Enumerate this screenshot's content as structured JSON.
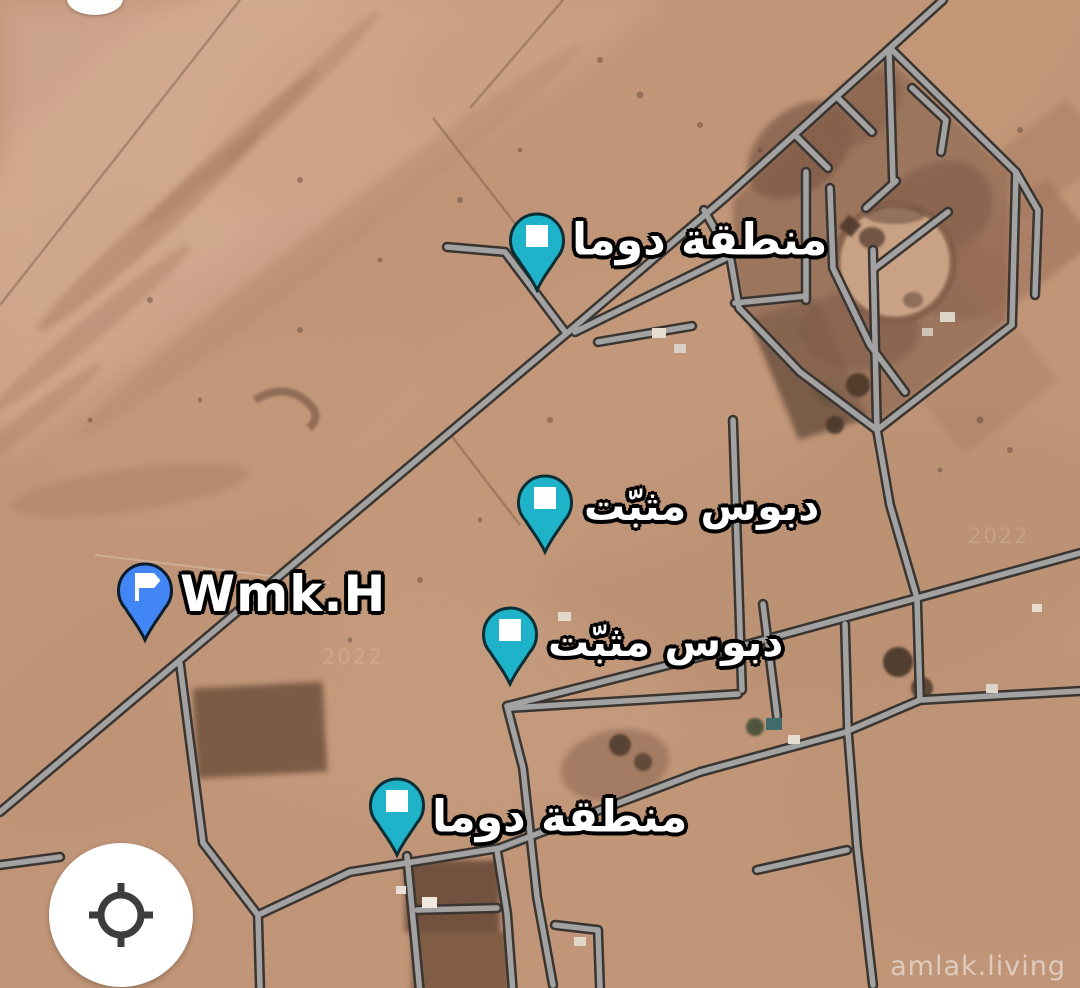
{
  "map": {
    "type": "satellite-imagery",
    "pins": [
      {
        "id": "pin-douma-north",
        "label": "منطقة دوما",
        "style": "teal-square-pin"
      },
      {
        "id": "pin-dropped-1",
        "label": "دبوس مثبّت",
        "style": "teal-square-pin"
      },
      {
        "id": "pin-dropped-2",
        "label": "دبوس مثبّت",
        "style": "teal-square-pin"
      },
      {
        "id": "pin-douma-south",
        "label": "منطقة دوما",
        "style": "teal-square-pin"
      },
      {
        "id": "pin-wmk",
        "label": "Wmk.H",
        "style": "blue-flag-pin"
      }
    ],
    "controls": {
      "locate_button": "my-location"
    },
    "ghost_year": "2022",
    "watermark": "amlak.living",
    "colors": {
      "pin_teal": "#1eb3c8",
      "pin_blue": "#4285f4",
      "road_fill": "#a3a2a2",
      "road_casing": "#3a3530",
      "sand": "#c19678"
    }
  }
}
